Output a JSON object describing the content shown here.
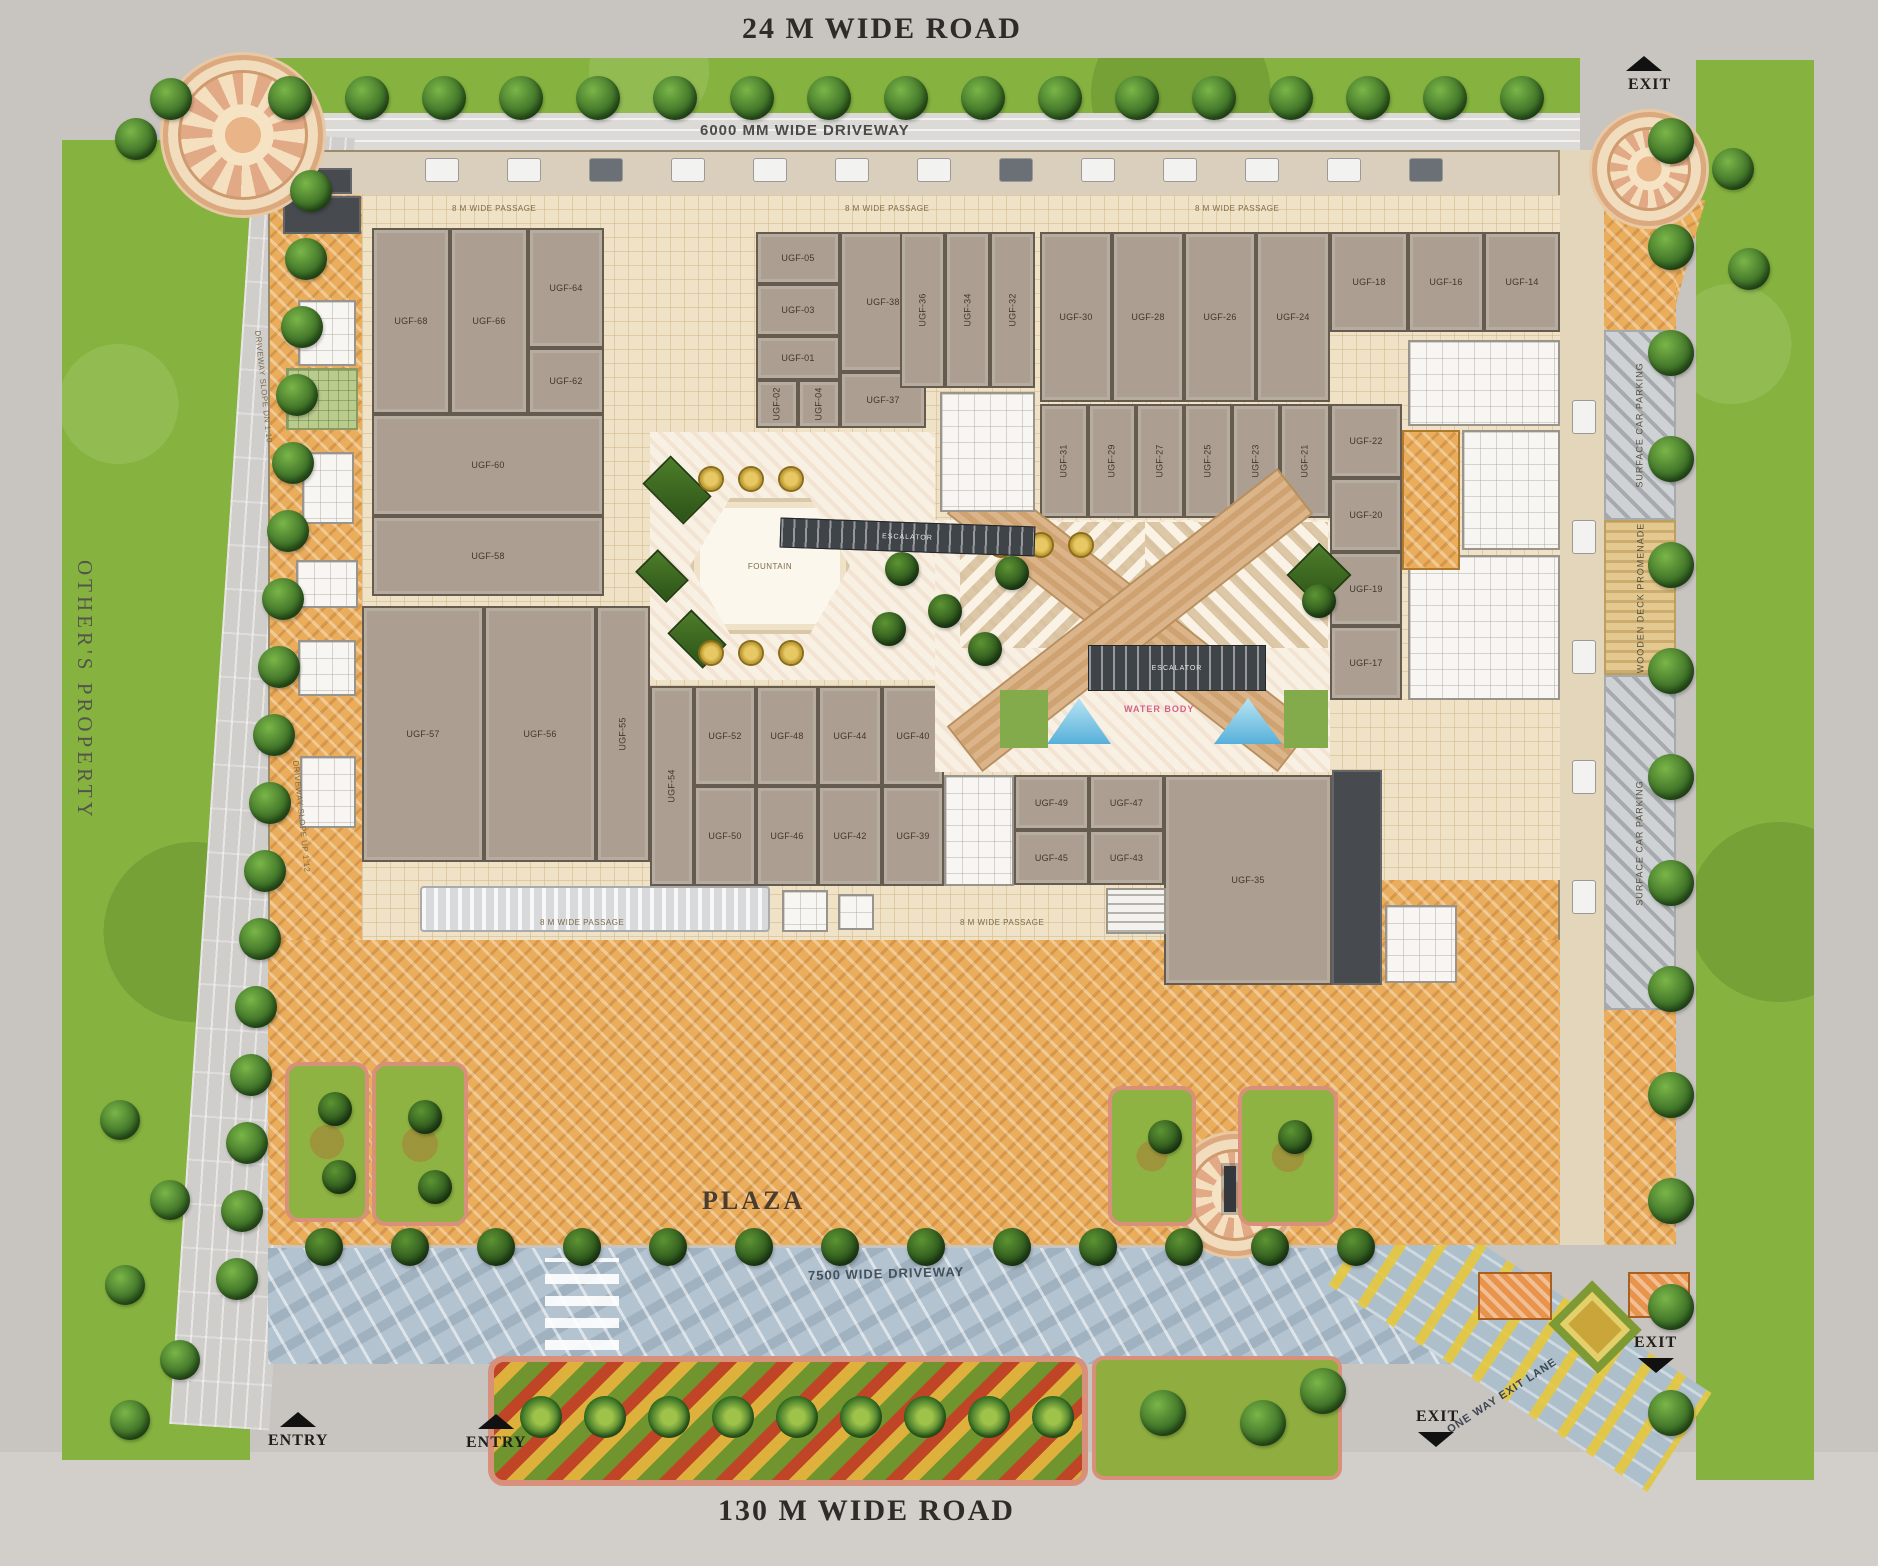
{
  "site": {
    "top_road": "24 M WIDE ROAD",
    "bottom_road": "130 M WIDE ROAD",
    "left_property": "OTHER'S PROPERTY",
    "top_driveway": "6000 MM WIDE DRIVEWAY",
    "bottom_driveway": "7500 WIDE DRIVEWAY",
    "plaza": "PLAZA",
    "ramp_upper": "DRIVEWAY SLOPE DN 1:10",
    "ramp_lower": "DRIVEWAY SLOPE UP 1:12",
    "one_way": "ONE WAY EXIT LANE",
    "entry": "ENTRY",
    "exit": "EXIT",
    "passage": "8 M WIDE PASSAGE",
    "parking_strip": "SURFACE CAR PARKING",
    "deck_strip": "WOODEN DECK PROMENADE",
    "fountain": "FOUNTAIN",
    "water": "WATER BODY",
    "escalator": "ESCALATOR",
    "colors": {
      "lawn": "#86b33f",
      "plaza_hatch": "#e9ad5c",
      "unit_fill": "#ac9f91",
      "water": "#7ec7e8",
      "driveway_blue": "#b7c6d3",
      "road_grey": "#c8c5c1"
    }
  },
  "units": [
    {
      "l": "UGF-68",
      "x": 372,
      "y": 228,
      "w": 78,
      "h": 186,
      "r": 0
    },
    {
      "l": "UGF-66",
      "x": 450,
      "y": 228,
      "w": 78,
      "h": 186,
      "r": 0
    },
    {
      "l": "UGF-64",
      "x": 528,
      "y": 228,
      "w": 76,
      "h": 120,
      "r": 0
    },
    {
      "l": "UGF-62",
      "x": 528,
      "y": 348,
      "w": 76,
      "h": 66,
      "r": 0
    },
    {
      "l": "UGF-60",
      "x": 372,
      "y": 414,
      "w": 232,
      "h": 102,
      "r": 0
    },
    {
      "l": "UGF-58",
      "x": 372,
      "y": 516,
      "w": 232,
      "h": 80,
      "r": 0
    },
    {
      "l": "UGF-05",
      "x": 756,
      "y": 232,
      "w": 84,
      "h": 52,
      "r": 0
    },
    {
      "l": "UGF-03",
      "x": 756,
      "y": 284,
      "w": 84,
      "h": 52,
      "r": 0
    },
    {
      "l": "UGF-01",
      "x": 756,
      "y": 336,
      "w": 84,
      "h": 44,
      "r": 0
    },
    {
      "l": "UGF-02",
      "x": 756,
      "y": 380,
      "w": 42,
      "h": 48,
      "r": 1
    },
    {
      "l": "UGF-04",
      "x": 798,
      "y": 380,
      "w": 42,
      "h": 48,
      "r": 1
    },
    {
      "l": "UGF-38",
      "x": 840,
      "y": 232,
      "w": 86,
      "h": 140,
      "r": 0
    },
    {
      "l": "UGF-37",
      "x": 840,
      "y": 372,
      "w": 86,
      "h": 56,
      "r": 0
    },
    {
      "l": "UGF-36",
      "x": 900,
      "y": 232,
      "w": 45,
      "h": 156,
      "r": 1
    },
    {
      "l": "UGF-34",
      "x": 945,
      "y": 232,
      "w": 45,
      "h": 156,
      "r": 1
    },
    {
      "l": "UGF-32",
      "x": 990,
      "y": 232,
      "w": 45,
      "h": 156,
      "r": 1
    },
    {
      "l": "UGF-30",
      "x": 1040,
      "y": 232,
      "w": 72,
      "h": 170,
      "r": 0
    },
    {
      "l": "UGF-28",
      "x": 1112,
      "y": 232,
      "w": 72,
      "h": 170,
      "r": 0
    },
    {
      "l": "UGF-26",
      "x": 1184,
      "y": 232,
      "w": 72,
      "h": 170,
      "r": 0
    },
    {
      "l": "UGF-24",
      "x": 1256,
      "y": 232,
      "w": 74,
      "h": 170,
      "r": 0
    },
    {
      "l": "UGF-31",
      "x": 1040,
      "y": 404,
      "w": 48,
      "h": 114,
      "r": 1
    },
    {
      "l": "UGF-29",
      "x": 1088,
      "y": 404,
      "w": 48,
      "h": 114,
      "r": 1
    },
    {
      "l": "UGF-27",
      "x": 1136,
      "y": 404,
      "w": 48,
      "h": 114,
      "r": 1
    },
    {
      "l": "UGF-25",
      "x": 1184,
      "y": 404,
      "w": 48,
      "h": 114,
      "r": 1
    },
    {
      "l": "UGF-23",
      "x": 1232,
      "y": 404,
      "w": 48,
      "h": 114,
      "r": 1
    },
    {
      "l": "UGF-21",
      "x": 1280,
      "y": 404,
      "w": 50,
      "h": 114,
      "r": 1
    },
    {
      "l": "UGF-18",
      "x": 1330,
      "y": 232,
      "w": 78,
      "h": 100,
      "r": 0
    },
    {
      "l": "UGF-16",
      "x": 1408,
      "y": 232,
      "w": 76,
      "h": 100,
      "r": 0
    },
    {
      "l": "UGF-14",
      "x": 1484,
      "y": 232,
      "w": 76,
      "h": 100,
      "r": 0
    },
    {
      "l": "UGF-22",
      "x": 1330,
      "y": 404,
      "w": 72,
      "h": 74,
      "r": 0
    },
    {
      "l": "UGF-20",
      "x": 1330,
      "y": 478,
      "w": 72,
      "h": 74,
      "r": 0
    },
    {
      "l": "UGF-19",
      "x": 1330,
      "y": 552,
      "w": 72,
      "h": 74,
      "r": 0
    },
    {
      "l": "UGF-17",
      "x": 1330,
      "y": 626,
      "w": 72,
      "h": 74,
      "r": 0
    },
    {
      "l": "UGF-57",
      "x": 362,
      "y": 606,
      "w": 122,
      "h": 256,
      "r": 0
    },
    {
      "l": "UGF-56",
      "x": 484,
      "y": 606,
      "w": 112,
      "h": 256,
      "r": 0
    },
    {
      "l": "UGF-55",
      "x": 596,
      "y": 606,
      "w": 54,
      "h": 256,
      "r": 1
    },
    {
      "l": "UGF-54",
      "x": 650,
      "y": 686,
      "w": 44,
      "h": 200,
      "r": 1
    },
    {
      "l": "UGF-52",
      "x": 694,
      "y": 686,
      "w": 62,
      "h": 100,
      "r": 0
    },
    {
      "l": "UGF-50",
      "x": 694,
      "y": 786,
      "w": 62,
      "h": 100,
      "r": 0
    },
    {
      "l": "UGF-48",
      "x": 756,
      "y": 686,
      "w": 62,
      "h": 100,
      "r": 0
    },
    {
      "l": "UGF-46",
      "x": 756,
      "y": 786,
      "w": 62,
      "h": 100,
      "r": 0
    },
    {
      "l": "UGF-44",
      "x": 818,
      "y": 686,
      "w": 64,
      "h": 100,
      "r": 0
    },
    {
      "l": "UGF-42",
      "x": 818,
      "y": 786,
      "w": 64,
      "h": 100,
      "r": 0
    },
    {
      "l": "UGF-40",
      "x": 882,
      "y": 686,
      "w": 62,
      "h": 100,
      "r": 0
    },
    {
      "l": "UGF-39",
      "x": 882,
      "y": 786,
      "w": 62,
      "h": 100,
      "r": 0
    },
    {
      "l": "UGF-49",
      "x": 1014,
      "y": 775,
      "w": 75,
      "h": 55,
      "r": 0
    },
    {
      "l": "UGF-47",
      "x": 1089,
      "y": 775,
      "w": 75,
      "h": 55,
      "r": 0
    },
    {
      "l": "UGF-45",
      "x": 1014,
      "y": 830,
      "w": 75,
      "h": 55,
      "r": 0
    },
    {
      "l": "UGF-43",
      "x": 1089,
      "y": 830,
      "w": 75,
      "h": 55,
      "r": 0
    },
    {
      "l": "UGF-35",
      "x": 1164,
      "y": 775,
      "w": 168,
      "h": 210,
      "r": 0
    }
  ]
}
